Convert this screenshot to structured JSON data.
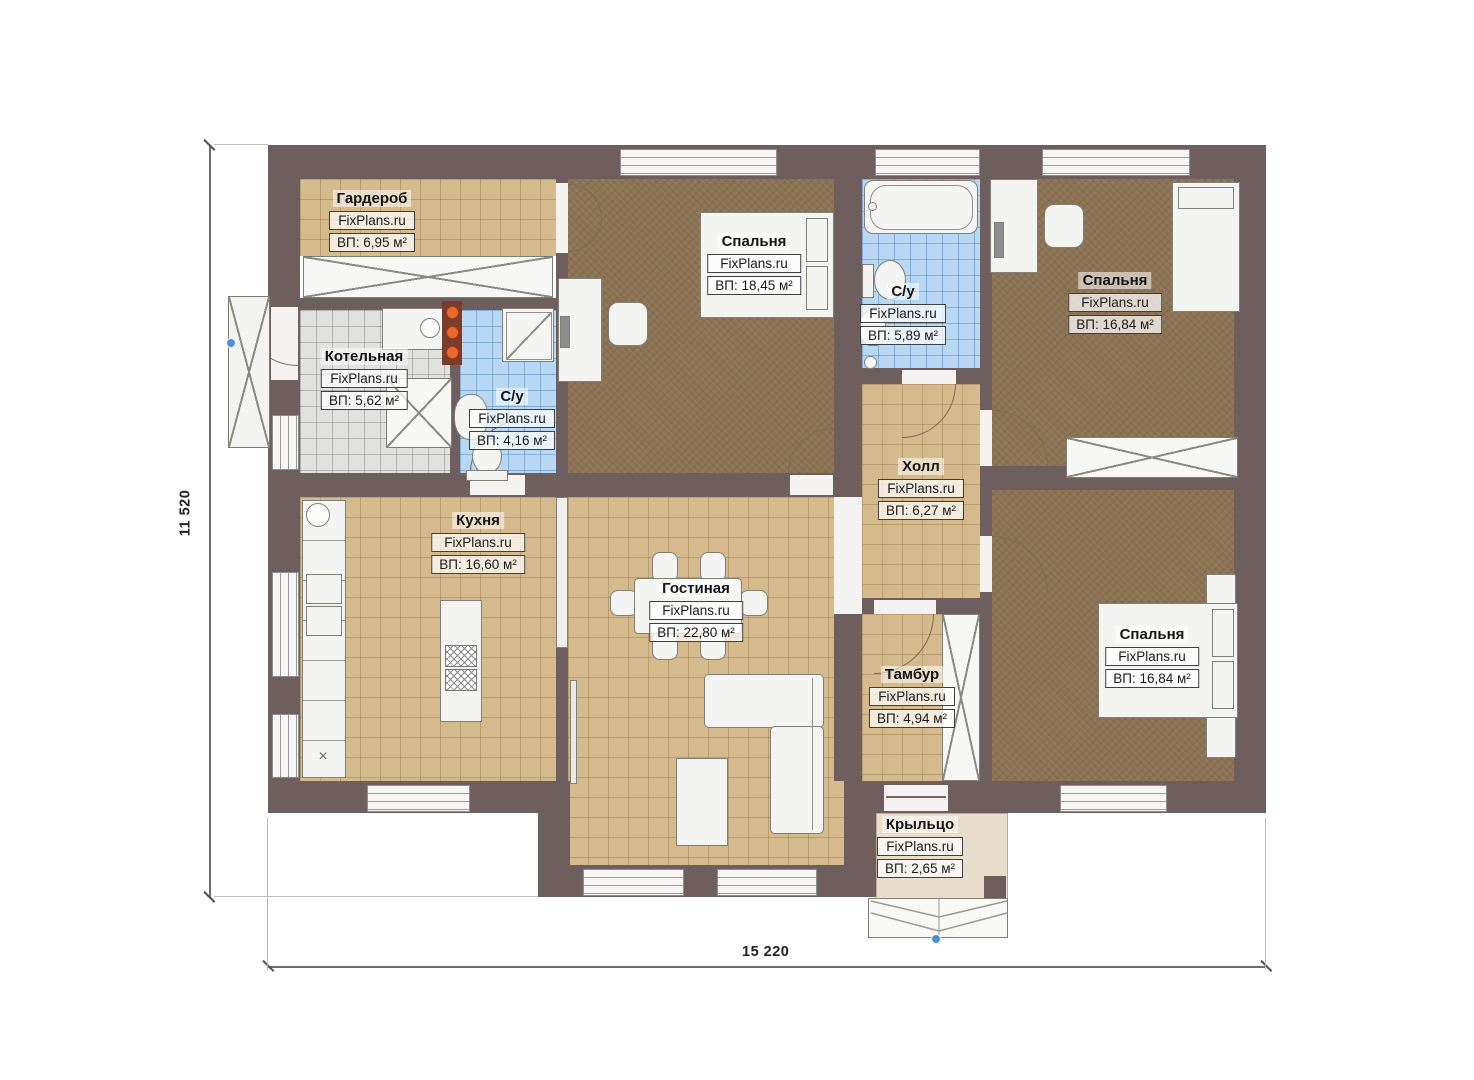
{
  "plan": {
    "watermark": "FixPlans.ru",
    "dimensions": {
      "height_label": "11 520",
      "width_label": "15 220"
    },
    "rooms": [
      {
        "id": "wardrobe",
        "name": "Гардероб",
        "area": "ВП: 6,95 м²"
      },
      {
        "id": "boiler",
        "name": "Котельная",
        "area": "ВП: 5,62 м²"
      },
      {
        "id": "bath-small",
        "name": "С/у",
        "area": "ВП: 4,16 м²"
      },
      {
        "id": "bedroom-1",
        "name": "Спальня",
        "area": "ВП: 18,45 м²"
      },
      {
        "id": "bath-main",
        "name": "С/у",
        "area": "ВП: 5,89 м²"
      },
      {
        "id": "bedroom-2",
        "name": "Спальня",
        "area": "ВП: 16,84 м²"
      },
      {
        "id": "hall",
        "name": "Холл",
        "area": "ВП: 6,27 м²"
      },
      {
        "id": "kitchen",
        "name": "Кухня",
        "area": "ВП: 16,60 м²"
      },
      {
        "id": "living",
        "name": "Гостиная",
        "area": "ВП: 22,80 м²"
      },
      {
        "id": "vestibule",
        "name": "Тамбур",
        "area": "ВП: 4,94 м²"
      },
      {
        "id": "bedroom-3",
        "name": "Спальня",
        "area": "ВП: 16,84 м²"
      },
      {
        "id": "porch",
        "name": "Крыльцо",
        "area": "ВП: 2,65 м²"
      }
    ],
    "colors": {
      "wall": "#6f5e5e",
      "tile_floor": "#d4ba8d",
      "bedroom_floor": "#8b7252",
      "bathroom_tile": "#b7d7f2",
      "boiler_tile": "#e1e1e0",
      "porch_floor": "#e8decb"
    }
  }
}
